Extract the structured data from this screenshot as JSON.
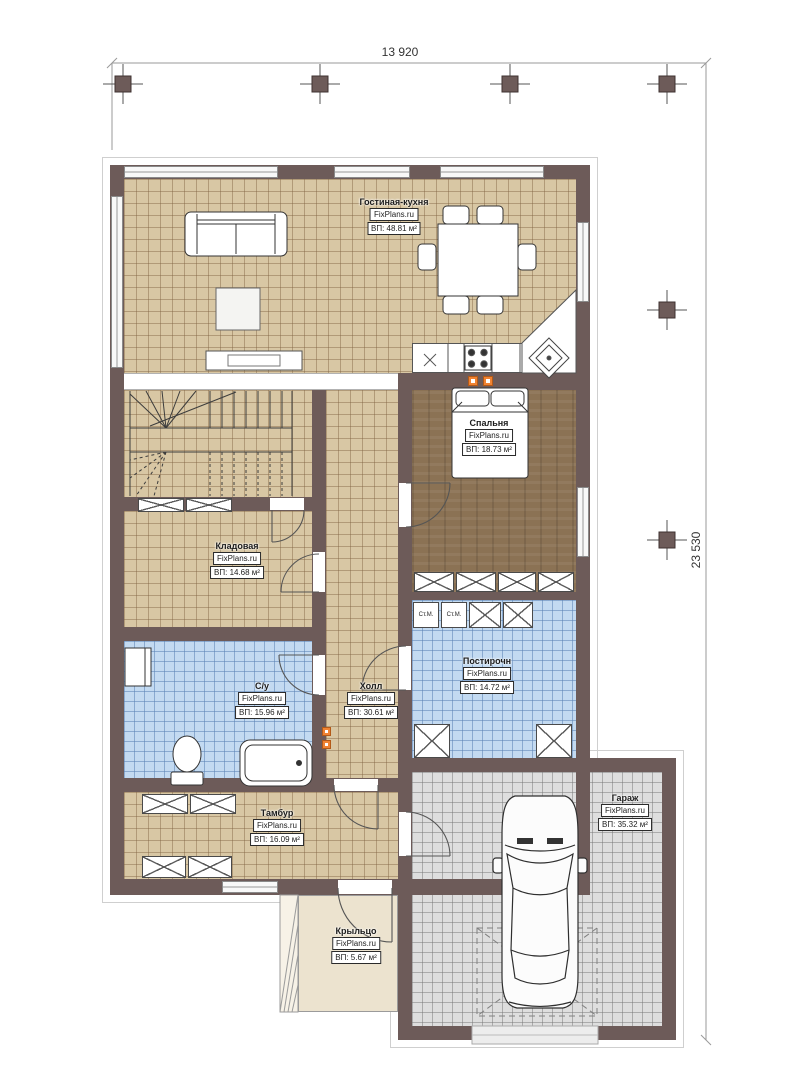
{
  "plan": {
    "dimensions": {
      "top": "13 920",
      "right": "23 530"
    }
  },
  "watermark": "FixPlans.ru",
  "rooms": [
    {
      "name": "Гостиная-кухня",
      "area": "ВП: 48.81 м²"
    },
    {
      "name": "Спальня",
      "area": "ВП: 18.73 м²"
    },
    {
      "name": "Кладовая",
      "area": "ВП: 14.68 м²"
    },
    {
      "name": "С/у",
      "area": "ВП: 15.96 м²"
    },
    {
      "name": "Холл",
      "area": "ВП: 30.61 м²"
    },
    {
      "name": "Постирочн",
      "area": "ВП: 14.72 м²"
    },
    {
      "name": "Тамбур",
      "area": "ВП: 16.09 м²"
    },
    {
      "name": "Крыльцо",
      "area": "ВП: 5.67 м²"
    },
    {
      "name": "Гараж",
      "area": "ВП: 35.32 м²"
    }
  ],
  "appliances": {
    "washer": "Ст.М."
  },
  "colors": {
    "wall": "#6d5b59",
    "floor_tile": "#d8c7a4",
    "floor_wood": "#8b7254",
    "floor_wet": "#c3daf1",
    "floor_garage": "#dedede",
    "floor_porch": "#ece3cf",
    "marker_accent": "#f08332"
  }
}
